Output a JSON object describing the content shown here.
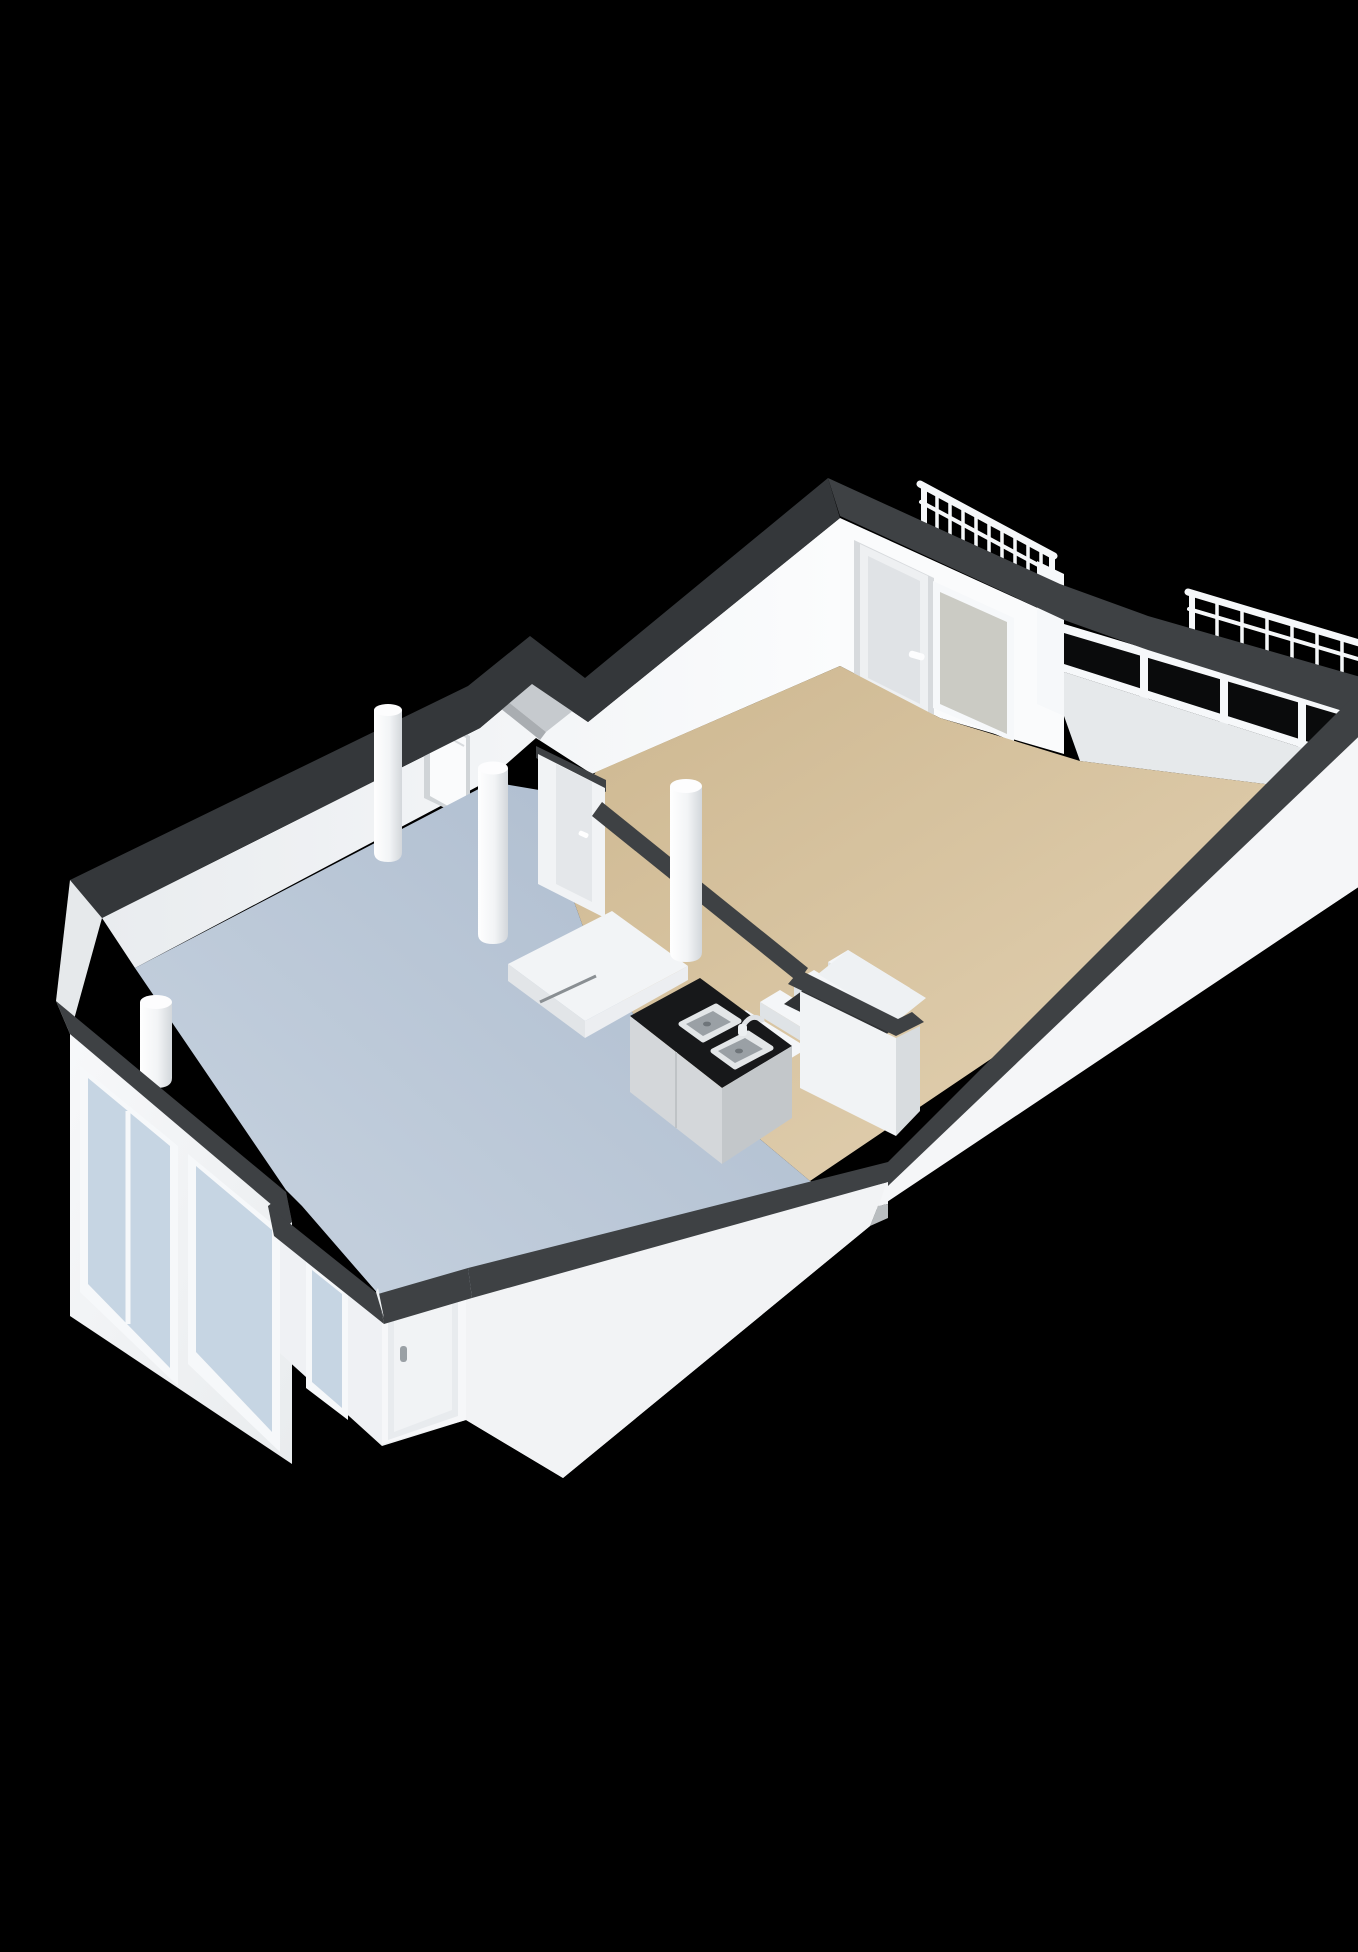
{
  "scene": {
    "type": "isometric-3d-floorplan-render",
    "background_color": "#000000",
    "view": "cutaway-from-above",
    "rooms": [
      {
        "id": "living-room",
        "position": "upper-right",
        "floor_color": "#d9c3a1"
      },
      {
        "id": "kitchen-living-room",
        "position": "lower-left",
        "floor_color": "#b9c5d5"
      }
    ],
    "features": [
      "balcony-railing-left",
      "balcony-railing-right",
      "top-door-with-handle",
      "frosted-window",
      "dark-corner-glazing",
      "kitchen-counter-black-top",
      "double-stainless-sink",
      "faucet",
      "staircase",
      "stair-landing",
      "storage-closet",
      "shower-tray",
      "round-columns",
      "interior-door",
      "alcove-door",
      "wall-shaft-notch",
      "side-windows-light-blue",
      "entry-vestibule",
      "entry-door-with-handle",
      "wall-step-notch"
    ],
    "colors": {
      "background": "#000000",
      "wall_top": "#3e4144",
      "wall_white": "#f4f6f8",
      "wall_shadow": "#d9dcdf",
      "floor_living": "#d9c3a1",
      "floor_kitchen": "#b9c5d5",
      "glass_dark": "#0a0b0c",
      "glass_light": "#c6d5e3",
      "glass_frosted": "#cbcbc4",
      "counter_top": "#17181a",
      "sink_steel": "#b9bec2",
      "railing": "#f5f7f9"
    }
  }
}
